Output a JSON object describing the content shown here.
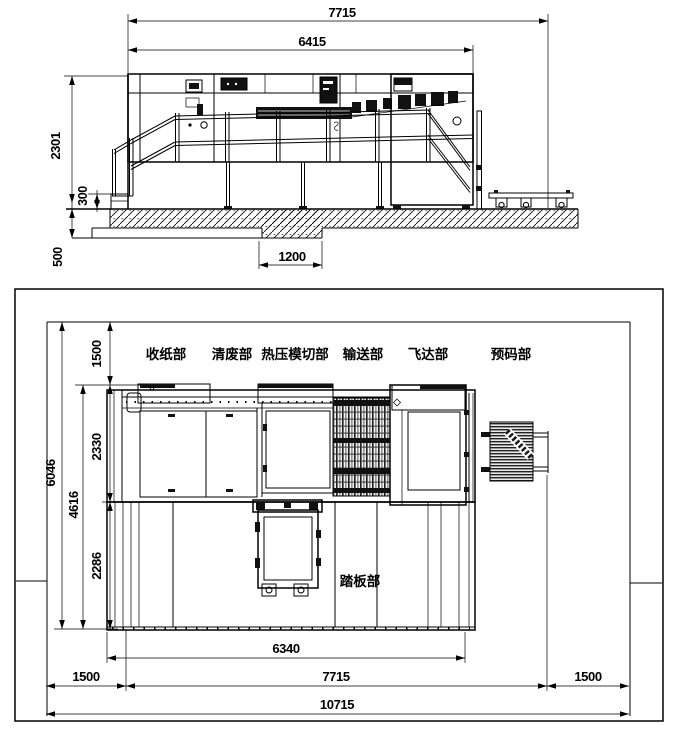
{
  "elevation": {
    "dims": {
      "overall_width": "7715",
      "machine_length": "6415",
      "machine_height": "2301",
      "base_height": "300",
      "foundation_depth": "500",
      "foundation_width": "1200"
    }
  },
  "plan": {
    "section_labels": [
      "收纸部",
      "清废部",
      "热压模切部",
      "输送部",
      "飞达部",
      "预码部"
    ],
    "pedal_label": "踏板部",
    "dims": {
      "rear_clearance": "1500",
      "machine_depth": "2330",
      "platform_depth": "2286",
      "machine_total_depth": "4616",
      "overall_depth": "6046",
      "platform_width": "6340",
      "machine_width": "7715",
      "left_clearance": "1500",
      "right_clearance": "1500",
      "overall_width": "10715"
    }
  }
}
